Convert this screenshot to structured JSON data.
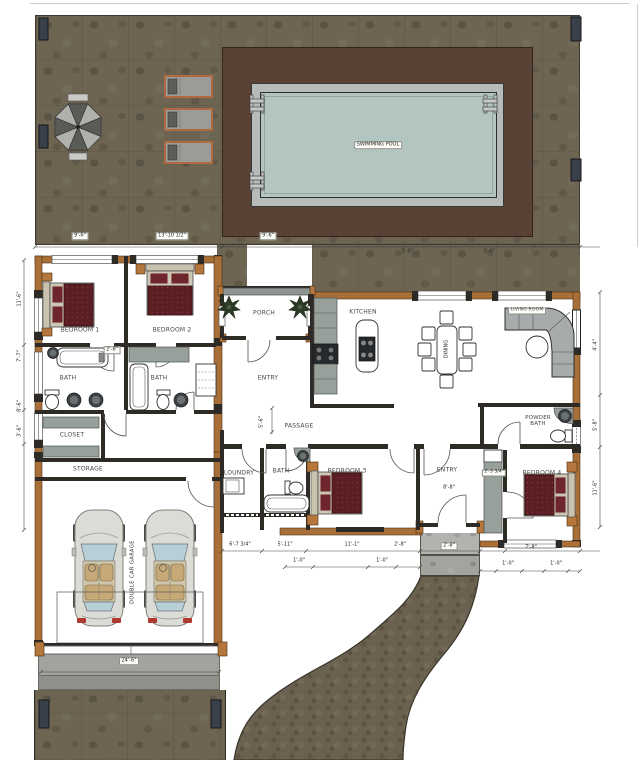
{
  "title": "Residential Floor Plan with Pool Deck",
  "colors": {
    "deck_stone": "#6d6452",
    "pool_surround": "#5a4136",
    "pool_water": "#b3c5c1",
    "wall_tan": "#a86f39",
    "bed_maroon": "#5a1e23",
    "counter_gray": "#98a09c"
  },
  "pool": {
    "label": "SWIMMING POOL"
  },
  "rooms": {
    "bedroom1": "BEDROOM 1",
    "bedroom2": "BEDROOM 2",
    "bath1": "BATH",
    "bath2": "BATH",
    "closet": "CLOSET",
    "storage": "STORAGE",
    "garage": "DOUBLE CAR GARAGE",
    "porch": "PORCH",
    "entry": "ENTRY",
    "kitchen": "KITCHEN",
    "passage": "PASSAGE",
    "dining": "DINING",
    "living": "LIVING ROOM",
    "powder": "POWDER BATH",
    "laundry": "LOUNDRY",
    "bath3": "BATH",
    "bedroom3": "BEDROOM 3",
    "entry2": "ENTRY",
    "bedroom4": "BEDROOM 4"
  },
  "dims": {
    "deck_a": "9'-6\"",
    "deck_b": "13'-10 1/2\"",
    "deck_c": "9'-6\"",
    "win_a": "3'-0\"",
    "win_b": "3'-0\"",
    "left_a": "11'-6\"",
    "left_b": "7'-7\"",
    "left_c": "8'-6\"",
    "left_d": "3'-6\"",
    "right_a": "4'-4\"",
    "right_b": "5'-8\"",
    "right_c": "11'-6\"",
    "mid_gap": "2'-8\"",
    "pass_h": "5'-6\"",
    "bot_a": "6'-7 3/4\"",
    "bot_b": "5'-11\"",
    "bot_c": "11'-1\"",
    "bot_d": "2'-8\"",
    "one_a": "1'-0\"",
    "one_b": "1'-0\"",
    "one_c": "1'-0\"",
    "one_d": "1'-0\"",
    "entry_w": "8'-8\"",
    "pad": "2'-8\"",
    "bed4_w": "7'-8\"",
    "cab": "2'-3 3/4\"",
    "drive": "24'-6\""
  }
}
